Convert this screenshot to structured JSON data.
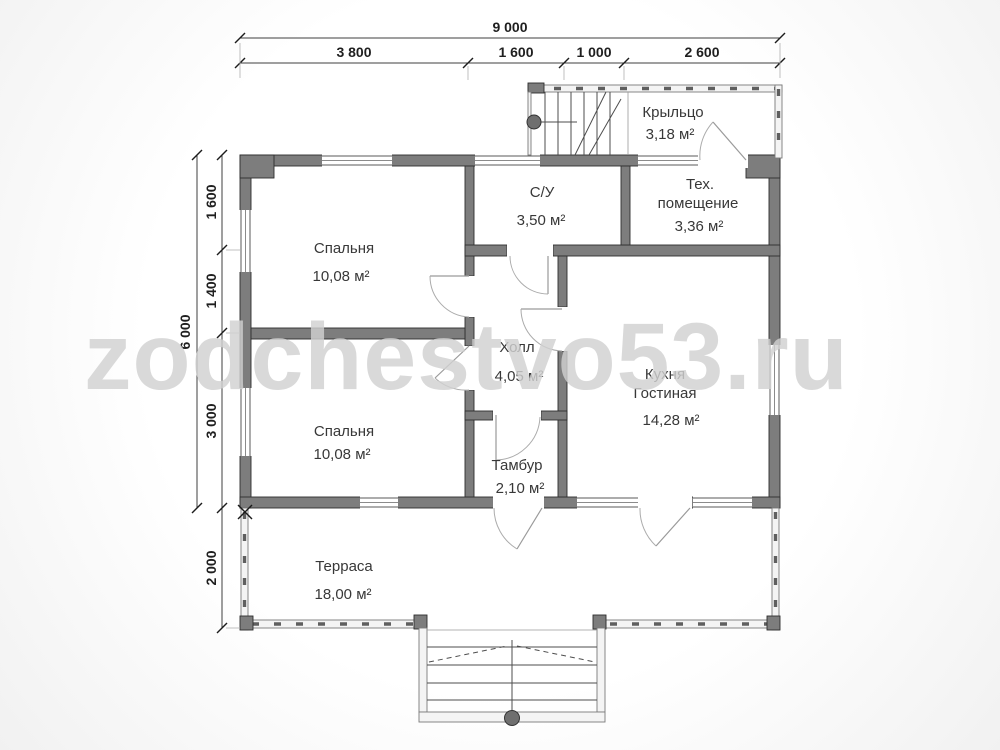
{
  "watermark": "zodchestvo53.ru",
  "dims": {
    "top_total": "9 000",
    "top_segments": [
      "3 800",
      "1 600",
      "1 000",
      "2 600"
    ],
    "left_total": "6 000",
    "left_segments": [
      "1 600",
      "1 400",
      "3 000",
      "2 000"
    ]
  },
  "rooms": {
    "porch": {
      "name": "Крыльцо",
      "area": "3,18 м²"
    },
    "bathroom": {
      "name": "С/У",
      "area": "3,50 м²"
    },
    "tech": {
      "name_line1": "Тех.",
      "name_line2": "помещение",
      "area": "3,36 м²"
    },
    "bedroom1": {
      "name": "Спальня",
      "area": "10,08 м²"
    },
    "hall": {
      "name": "Холл",
      "area": "4,05 м²"
    },
    "kitchen": {
      "name_line1": "Кухня",
      "name_line2": "Гостиная",
      "area": "14,28 м²"
    },
    "bedroom2": {
      "name": "Спальня",
      "area": "10,08 м²"
    },
    "vestibule": {
      "name": "Тамбур",
      "area": "2,10 м²"
    },
    "terrace": {
      "name": "Терраса",
      "area": "18,00 м²"
    }
  },
  "colors": {
    "wall": "#7d7d7d",
    "wall_edge": "#2e2e2e",
    "thin_wall": "#f4f4f4",
    "line": "#4d4d4d",
    "label_text": "#383838",
    "watermark": "#d1d1d1"
  }
}
